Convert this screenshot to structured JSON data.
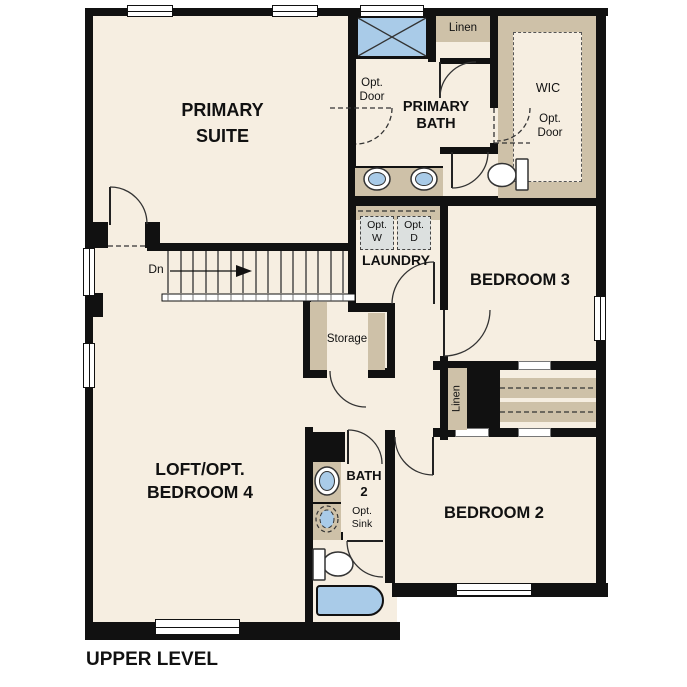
{
  "colors": {
    "floor": "#f6eee1",
    "wall": "#111111",
    "tan": "#cec1a8",
    "blue": "#a9cbe8",
    "appliance": "#dce0df",
    "line": "#333333",
    "text": "#111111",
    "background": "#ffffff"
  },
  "labels": {
    "primary_suite": "PRIMARY\nSUITE",
    "opt_door_bath": "Opt.\nDoor",
    "primary_bath": "PRIMARY\nBATH",
    "linen_top": "Linen",
    "wic": "WIC",
    "opt_door_wic": "Opt.\nDoor",
    "opt_washer": "Opt.\nW",
    "opt_dryer": "Opt.\nD",
    "laundry": "LAUNDRY",
    "bedroom3": "BEDROOM 3",
    "stairs_dn": "Dn",
    "storage": "Storage",
    "linen_closet": "Linen",
    "loft": "LOFT/OPT.\nBEDROOM 4",
    "bath2": "BATH\n2",
    "opt_sink": "Opt.\nSink",
    "bedroom2": "BEDROOM 2",
    "plan_title": "UPPER LEVEL"
  }
}
